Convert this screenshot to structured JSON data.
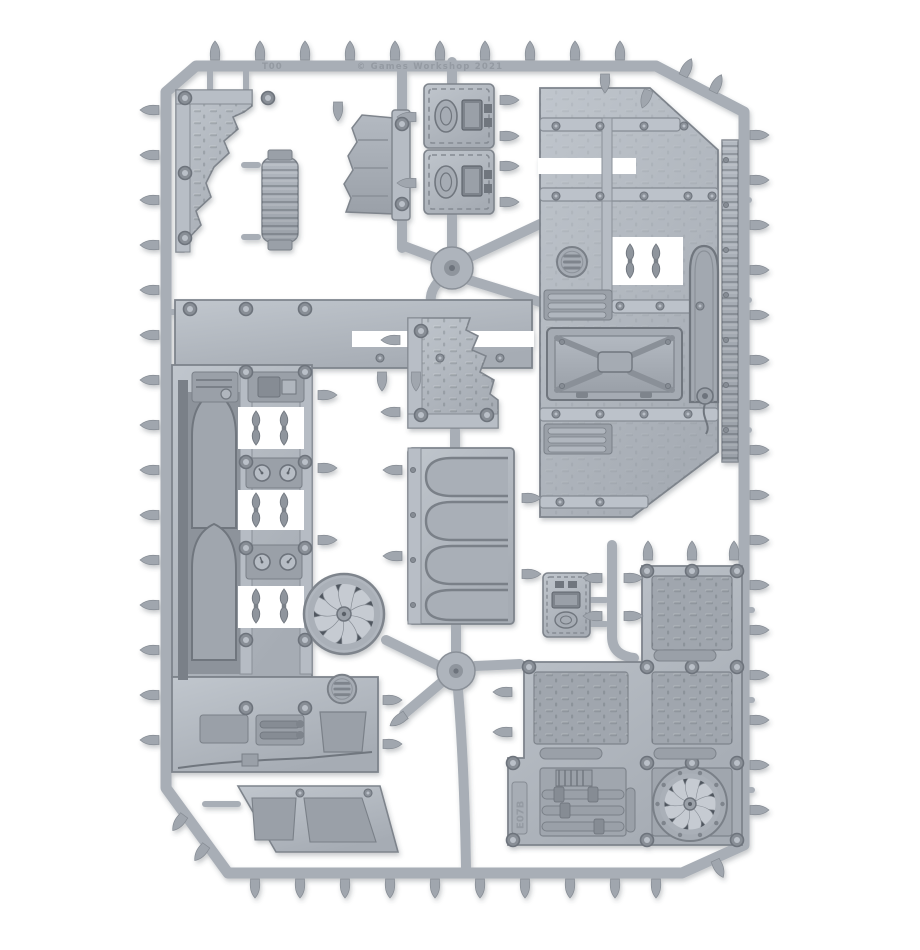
{
  "image": {
    "type": "product-photo",
    "subject": "Grey plastic model kit sprue of industrial terrain parts photographed on a white background"
  },
  "palette": {
    "background": "#ffffff",
    "plastic_base": "#aeb4bc",
    "plastic_light": "#c6cbd2",
    "plastic_mid": "#9aa0a8",
    "plastic_dark": "#7e848c",
    "plastic_shadow": "#6d737b",
    "fan_backdrop": "#50565e"
  },
  "markings": {
    "top_left_code": "T00",
    "top_center_text": "© Games Workshop 2021",
    "panel_code": "E07B"
  },
  "contents": {
    "industrial_fans": 2,
    "vent_grilles": 2,
    "control_consoles": 3,
    "gothic_arches": 4,
    "floor_plates": 5,
    "ruined_wall_pieces": 3,
    "valve_handle_pairs": 4,
    "pressure_gauges": 4,
    "hatch_doors": 1,
    "support_pillars": 1
  },
  "parts_list": [
    {
      "name": "ruined-corner-wall-piece",
      "label": "Ruined corner wall"
    },
    {
      "name": "support-pillar-piece",
      "label": "Ribbed support pillar"
    },
    {
      "name": "wall-bracket-piece",
      "label": "Broken wall bracket"
    },
    {
      "name": "control-console-piece",
      "label": "Control console (x2)"
    },
    {
      "name": "right-wall-section",
      "label": "Large wall with hatch and vent"
    },
    {
      "name": "ladder-rail-piece",
      "label": "Ladder rail strip"
    },
    {
      "name": "left-wall-section",
      "label": "Large arched wall with fittings"
    },
    {
      "name": "industrial-fan",
      "label": "Bladed fan (x2)"
    },
    {
      "name": "gothic-arch-panel",
      "label": "Four-arch window panel"
    },
    {
      "name": "ruined-floor-corner-piece",
      "label": "Ruined floor corner"
    },
    {
      "name": "mini-console-piece",
      "label": "Small console"
    },
    {
      "name": "floor-plate-assembly",
      "label": "Treadplate floor with fan and pipes"
    },
    {
      "name": "walkway-piece",
      "label": "Angled walkway section"
    }
  ]
}
